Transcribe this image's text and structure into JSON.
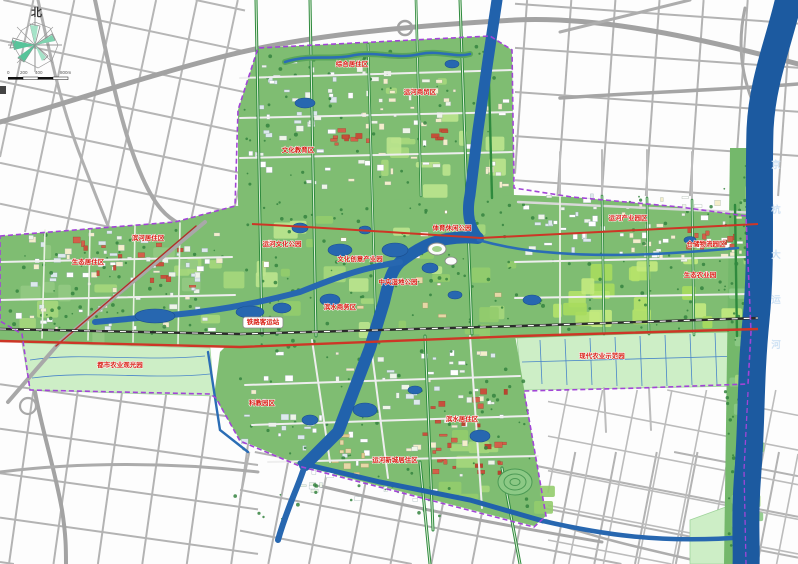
{
  "compass": {
    "north_label": "北"
  },
  "scale_bar": {
    "labels": [
      "0",
      "200",
      "400",
      "800m"
    ]
  },
  "waterways": {
    "grand_canal": "京杭大运河"
  },
  "labels": [
    {
      "text": "综合居住区",
      "x": 352,
      "y": 66
    },
    {
      "text": "运河商贸区",
      "x": 420,
      "y": 94
    },
    {
      "text": "文化教育区",
      "x": 298,
      "y": 152
    },
    {
      "text": "滨河居住区",
      "x": 148,
      "y": 240
    },
    {
      "text": "生态居住区",
      "x": 88,
      "y": 264
    },
    {
      "text": "运河文化公园",
      "x": 282,
      "y": 246
    },
    {
      "text": "文化创意产业园",
      "x": 360,
      "y": 261
    },
    {
      "text": "中央湿地公园",
      "x": 398,
      "y": 284
    },
    {
      "text": "滨水商务区",
      "x": 340,
      "y": 309
    },
    {
      "text": "铁路客运站",
      "x": 263,
      "y": 324
    },
    {
      "text": "体育休闲公园",
      "x": 452,
      "y": 230
    },
    {
      "text": "运河产业园区",
      "x": 628,
      "y": 220
    },
    {
      "text": "仓储物流园区",
      "x": 706,
      "y": 246
    },
    {
      "text": "生态农业园",
      "x": 700,
      "y": 277
    },
    {
      "text": "都市农业观光园",
      "x": 120,
      "y": 367
    },
    {
      "text": "现代农业示范园",
      "x": 602,
      "y": 358
    },
    {
      "text": "科教园区",
      "x": 262,
      "y": 405
    },
    {
      "text": "运河新城居住区",
      "x": 395,
      "y": 462
    },
    {
      "text": "滨水居住区",
      "x": 462,
      "y": 421
    }
  ],
  "colors": {
    "plan_green": "#7fbd72",
    "pale_field": "#cdeec6",
    "bright_field": "#b5e26a",
    "water": "#2162ac",
    "grand_canal": "#1c5aa0",
    "red_road": "#cd3626",
    "railway": "#2b2b2b",
    "boundary": "#a245d6",
    "outer_road": "#b3b3b3",
    "label_red": "#d81e14"
  }
}
